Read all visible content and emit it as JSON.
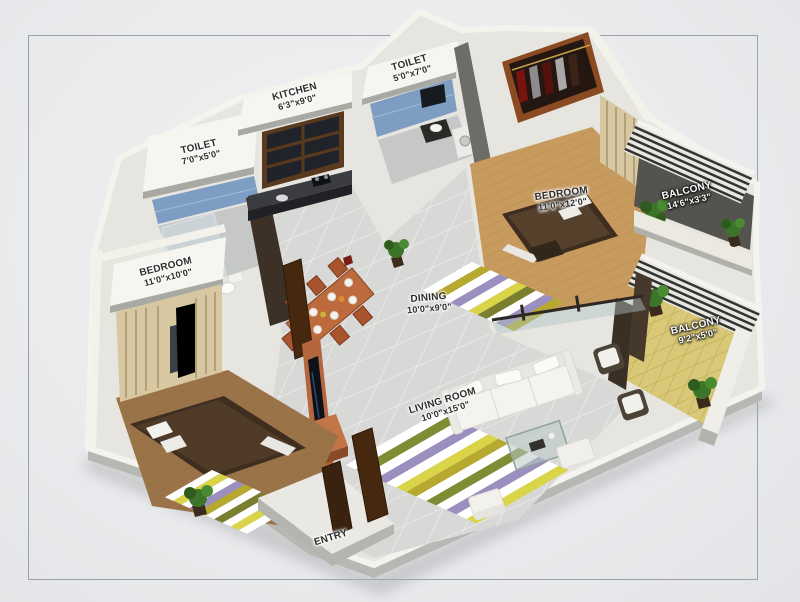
{
  "scene": {
    "type": "3d-isometric-floor-plan",
    "background": "#e9eaec",
    "frame_color": "#9ca1a6",
    "palette": {
      "wall_white": "#f6f5ef",
      "wall_shadow": "#a9a9a4",
      "tile_floor": "#d8d9d7",
      "wood_floor": "#c79a5e",
      "wood_floor_dark": "#9b7348",
      "tile_blue": "#7e9dc2",
      "door_brown": "#46280f",
      "tv_wood": "#b4673f",
      "deck_yellow": "#d9c877",
      "plant_green": "#3c7429",
      "sofa_white": "#f4f3ef",
      "bed_brown": "#3f2e1f",
      "rug_colors": [
        "#ffffff",
        "#b7a92f",
        "#9b8fc0",
        "#d9d448",
        "#7f8c34"
      ]
    }
  },
  "labels": {
    "toilet_left": {
      "name": "TOILET",
      "dims": "7'0\"x5'0\""
    },
    "kitchen": {
      "name": "KITCHEN",
      "dims": "6'3\"x9'0\""
    },
    "toilet_top": {
      "name": "TOILET",
      "dims": "5'0\"x7'0\""
    },
    "bedroom_right": {
      "name": "BEDROOM",
      "dims": "11'0\"x12'0\""
    },
    "balcony_top": {
      "name": "BALCONY",
      "dims": "14'6\"x3'3\""
    },
    "balcony_right": {
      "name": "BALCONY",
      "dims": "9'2\"x5'0\""
    },
    "dining": {
      "name": "DINING",
      "dims": "10'0\"x9'0\""
    },
    "living_room": {
      "name": "LIVING ROOM",
      "dims": "10'0\"x15'0\""
    },
    "bedroom_left": {
      "name": "BEDROOM",
      "dims": "11'0\"x10'0\""
    },
    "entry": {
      "name": "ENTRY"
    }
  }
}
